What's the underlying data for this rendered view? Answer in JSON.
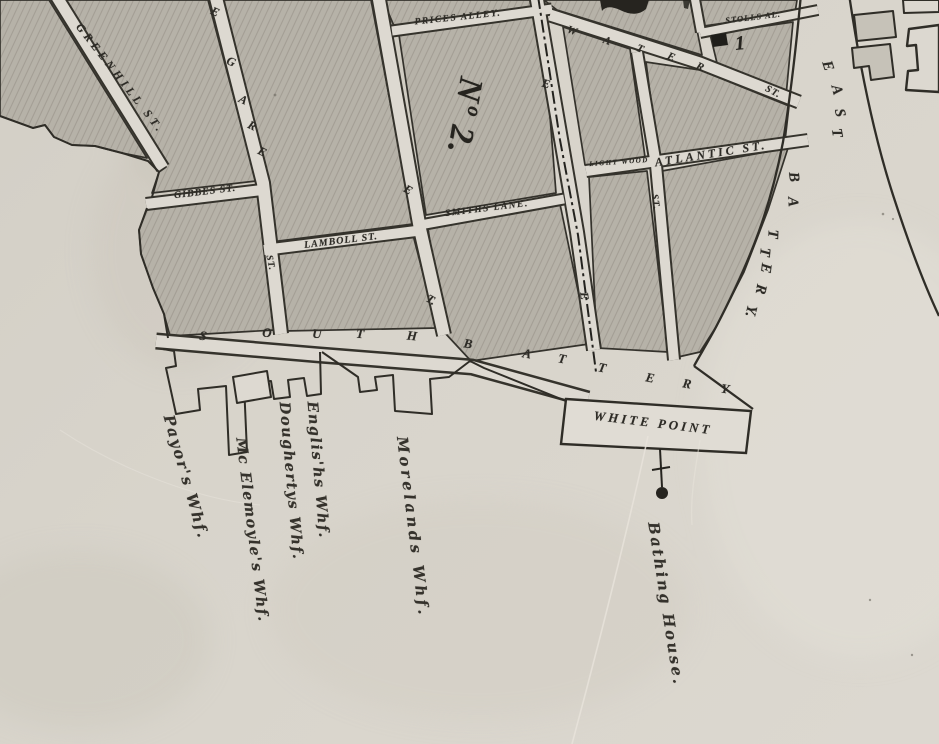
{
  "map": {
    "type": "historical-city-map-scan",
    "ward_numbers": {
      "large_numeral": "Nº 2.",
      "small_numeral": "1"
    },
    "palette": {
      "paper": "#dcd8d0",
      "block_fill": "#b6b2a8",
      "hatch_line": "#948e82",
      "ink": "#2d2b26",
      "building_fill": "#c6c2b8"
    },
    "labels": [
      {
        "name": "street-label-greenhill-st",
        "text": "GREENHILL ST.",
        "x": 120,
        "y": 79,
        "rot": 52,
        "cls": "stencil",
        "fs": 11.5,
        "ls": 4
      },
      {
        "name": "street-letter-legare-e1",
        "text": "E",
        "x": 215,
        "y": 12,
        "rot": 24,
        "cls": "stencil",
        "fs": 12,
        "ls": 0
      },
      {
        "name": "street-letter-legare-g",
        "text": "G",
        "x": 231,
        "y": 62,
        "rot": 24,
        "cls": "stencil",
        "fs": 12,
        "ls": 0
      },
      {
        "name": "street-letter-legare-a",
        "text": "A",
        "x": 243,
        "y": 100,
        "rot": 25,
        "cls": "stencil",
        "fs": 12,
        "ls": 0
      },
      {
        "name": "street-letter-legare-r",
        "text": "R",
        "x": 252,
        "y": 126,
        "rot": 26,
        "cls": "stencil",
        "fs": 12,
        "ls": 0
      },
      {
        "name": "street-letter-legare-e2",
        "text": "E",
        "x": 262,
        "y": 152,
        "rot": 27,
        "cls": "stencil",
        "fs": 12,
        "ls": 0
      },
      {
        "name": "street-label-legare-st",
        "text": "ST.",
        "x": 270,
        "y": 263,
        "rot": 78,
        "cls": "stencil",
        "fs": 9.5,
        "ls": 1
      },
      {
        "name": "street-label-gibbes-st",
        "text": "GIBBES ST.",
        "x": 205,
        "y": 192,
        "rot": -7,
        "cls": "stencil",
        "fs": 10,
        "ls": 1
      },
      {
        "name": "street-label-lamboll-st",
        "text": "LAMBOLL ST.",
        "x": 341,
        "y": 241,
        "rot": -7,
        "cls": "stencil",
        "fs": 10,
        "ls": 1
      },
      {
        "name": "street-label-prices-alley",
        "text": "PRICES ALLEY.",
        "x": 458,
        "y": 18,
        "rot": -6,
        "cls": "stencil",
        "fs": 9.5,
        "ls": 1.5
      },
      {
        "name": "ward-number-2",
        "text": "Nº 2.",
        "x": 464,
        "y": 116,
        "rot": 100,
        "cls": "ward",
        "fs": 34,
        "ls": 2
      },
      {
        "name": "street-label-smiths-lane",
        "text": "SMITHS LANE.",
        "x": 487,
        "y": 209,
        "rot": -7,
        "cls": "stencil",
        "fs": 9.5,
        "ls": 1.5
      },
      {
        "name": "street-letter-meeting-e",
        "text": "E",
        "x": 408,
        "y": 190,
        "rot": 30,
        "cls": "stencil",
        "fs": 12,
        "ls": 0
      },
      {
        "name": "street-letter-meeting-t",
        "text": "T.",
        "x": 431,
        "y": 300,
        "rot": 30,
        "cls": "stencil",
        "fs": 12,
        "ls": 0
      },
      {
        "name": "street-letter-church-e-upper",
        "text": "E",
        "x": 546,
        "y": 84,
        "rot": 15,
        "cls": "stencil",
        "fs": 12,
        "ls": 0
      },
      {
        "name": "street-letter-church-e-lower",
        "text": "E",
        "x": 584,
        "y": 296,
        "rot": 82,
        "cls": "stencil",
        "fs": 12,
        "ls": 0
      },
      {
        "name": "street-letter-water-w",
        "text": "W",
        "x": 572,
        "y": 31,
        "rot": 20,
        "cls": "stencil",
        "fs": 11,
        "ls": 0
      },
      {
        "name": "street-letter-water-a",
        "text": "A",
        "x": 607,
        "y": 41,
        "rot": 21,
        "cls": "stencil",
        "fs": 11,
        "ls": 0
      },
      {
        "name": "street-letter-water-t",
        "text": "T",
        "x": 640,
        "y": 49,
        "rot": 22,
        "cls": "stencil",
        "fs": 11,
        "ls": 0
      },
      {
        "name": "street-letter-water-e",
        "text": "E",
        "x": 671,
        "y": 57,
        "rot": 23,
        "cls": "stencil",
        "fs": 11,
        "ls": 0
      },
      {
        "name": "street-letter-water-r",
        "text": "R",
        "x": 700,
        "y": 67,
        "rot": 24,
        "cls": "stencil",
        "fs": 11,
        "ls": 0
      },
      {
        "name": "street-label-water-st",
        "text": "ST.",
        "x": 773,
        "y": 92,
        "rot": 28,
        "cls": "stencil",
        "fs": 10,
        "ls": 1
      },
      {
        "name": "street-label-stolls-alley",
        "text": "STOLLS AL.",
        "x": 753,
        "y": 17,
        "rot": -7,
        "cls": "stencil",
        "fs": 8.5,
        "ls": 1
      },
      {
        "name": "ward-number-1",
        "text": "1",
        "x": 740,
        "y": 44,
        "rot": -5,
        "cls": "ward",
        "fs": 20,
        "ls": 0
      },
      {
        "name": "street-label-lightwood",
        "text": "LIGHT WOOD",
        "x": 619,
        "y": 162,
        "rot": -4,
        "cls": "stencil",
        "fs": 7,
        "ls": 1.5
      },
      {
        "name": "street-label-atlantic-st",
        "text": "ATLANTIC ST.",
        "x": 711,
        "y": 154,
        "rot": -9,
        "cls": "stencil",
        "fs": 12,
        "ls": 3
      },
      {
        "name": "street-label-church-st",
        "text": "ST.",
        "x": 655,
        "y": 202,
        "rot": 82,
        "cls": "stencil",
        "fs": 9.5,
        "ls": 1
      },
      {
        "name": "street-letter-eastbattery-e1",
        "text": "E",
        "x": 827,
        "y": 66,
        "rot": 72,
        "cls": "stencil",
        "fs": 15,
        "ls": 0
      },
      {
        "name": "street-letter-eastbattery-a1",
        "text": "A",
        "x": 836,
        "y": 90,
        "rot": 75,
        "cls": "stencil",
        "fs": 15,
        "ls": 0
      },
      {
        "name": "street-letter-eastbattery-s",
        "text": "S",
        "x": 839,
        "y": 113,
        "rot": 78,
        "cls": "stencil",
        "fs": 15,
        "ls": 0
      },
      {
        "name": "street-letter-eastbattery-t1",
        "text": "T",
        "x": 836,
        "y": 133,
        "rot": 80,
        "cls": "stencil",
        "fs": 15,
        "ls": 0
      },
      {
        "name": "street-letter-eastbattery-b",
        "text": "B",
        "x": 793,
        "y": 177,
        "rot": 84,
        "cls": "stencil",
        "fs": 15,
        "ls": 0
      },
      {
        "name": "street-letter-eastbattery-a2",
        "text": "A",
        "x": 792,
        "y": 202,
        "rot": 87,
        "cls": "stencil",
        "fs": 15,
        "ls": 0
      },
      {
        "name": "street-letter-eastbattery-t2",
        "text": "T",
        "x": 772,
        "y": 234,
        "rot": 92,
        "cls": "stencil",
        "fs": 15,
        "ls": 0
      },
      {
        "name": "street-letter-eastbattery-t3",
        "text": "T",
        "x": 764,
        "y": 252,
        "rot": 95,
        "cls": "stencil",
        "fs": 15,
        "ls": 0
      },
      {
        "name": "street-letter-eastbattery-e2",
        "text": "E",
        "x": 765,
        "y": 268,
        "rot": 97,
        "cls": "stencil",
        "fs": 15,
        "ls": 0
      },
      {
        "name": "street-letter-eastbattery-r",
        "text": "R",
        "x": 760,
        "y": 289,
        "rot": 100,
        "cls": "stencil",
        "fs": 15,
        "ls": 0
      },
      {
        "name": "street-letter-eastbattery-y",
        "text": "Y.",
        "x": 750,
        "y": 311,
        "rot": 104,
        "cls": "stencil",
        "fs": 15,
        "ls": 0
      },
      {
        "name": "street-letter-southbattery-s",
        "text": "S",
        "x": 203,
        "y": 336,
        "rot": 8,
        "cls": "stencil",
        "fs": 13,
        "ls": 0
      },
      {
        "name": "street-letter-southbattery-o",
        "text": "O",
        "x": 267,
        "y": 333,
        "rot": 4,
        "cls": "stencil",
        "fs": 13,
        "ls": 0
      },
      {
        "name": "street-letter-southbattery-u",
        "text": "U",
        "x": 317,
        "y": 334,
        "rot": 4,
        "cls": "stencil",
        "fs": 13,
        "ls": 0
      },
      {
        "name": "street-letter-southbattery-t1",
        "text": "T",
        "x": 360,
        "y": 334,
        "rot": 5,
        "cls": "stencil",
        "fs": 13,
        "ls": 0
      },
      {
        "name": "street-letter-southbattery-h",
        "text": "H",
        "x": 412,
        "y": 336,
        "rot": 6,
        "cls": "stencil",
        "fs": 13,
        "ls": 0
      },
      {
        "name": "street-letter-southbattery-b",
        "text": "B",
        "x": 468,
        "y": 344,
        "rot": 9,
        "cls": "stencil",
        "fs": 13,
        "ls": 0
      },
      {
        "name": "street-letter-southbattery-a",
        "text": "A",
        "x": 527,
        "y": 354,
        "rot": 10,
        "cls": "stencil",
        "fs": 13,
        "ls": 0
      },
      {
        "name": "street-letter-southbattery-t2",
        "text": "T",
        "x": 562,
        "y": 359,
        "rot": 10,
        "cls": "stencil",
        "fs": 13,
        "ls": 0
      },
      {
        "name": "street-letter-southbattery-t3",
        "text": "T",
        "x": 602,
        "y": 368,
        "rot": 11,
        "cls": "stencil",
        "fs": 13,
        "ls": 0
      },
      {
        "name": "street-letter-southbattery-e",
        "text": "E",
        "x": 650,
        "y": 378,
        "rot": 11,
        "cls": "stencil",
        "fs": 13,
        "ls": 0
      },
      {
        "name": "street-letter-southbattery-r",
        "text": "R",
        "x": 687,
        "y": 384,
        "rot": 10,
        "cls": "stencil",
        "fs": 13,
        "ls": 0
      },
      {
        "name": "street-letter-southbattery-y",
        "text": "Y",
        "x": 725,
        "y": 389,
        "rot": 10,
        "cls": "stencil",
        "fs": 13,
        "ls": 0
      },
      {
        "name": "place-label-white-point",
        "text": "WHITE POINT",
        "x": 653,
        "y": 423,
        "rot": 7,
        "cls": "stencil",
        "fs": 13,
        "ls": 3
      },
      {
        "name": "place-label-bathing-house",
        "text": "Bathing House.",
        "x": 666,
        "y": 604,
        "rot": 81,
        "cls": "script",
        "fs": 15,
        "ls": 2.5
      },
      {
        "name": "wharf-label-payors",
        "text": "Payor's Whf.",
        "x": 186,
        "y": 477,
        "rot": 74,
        "cls": "script",
        "fs": 15,
        "ls": 2
      },
      {
        "name": "wharf-label-mc-elemoyles",
        "text": "Mc Elemoyle's Whf.",
        "x": 252,
        "y": 530,
        "rot": 83,
        "cls": "script",
        "fs": 14.5,
        "ls": 1.5
      },
      {
        "name": "wharf-label-doughertys",
        "text": "Doughertys Whf.",
        "x": 291,
        "y": 481,
        "rot": 85,
        "cls": "script",
        "fs": 14.5,
        "ls": 1.5
      },
      {
        "name": "wharf-label-englishs",
        "text": "Englis'hs Whf.",
        "x": 318,
        "y": 470,
        "rot": 85,
        "cls": "script",
        "fs": 14.5,
        "ls": 1.5
      },
      {
        "name": "wharf-label-morelands",
        "text": "Morelands Whf.",
        "x": 413,
        "y": 527,
        "rot": 83,
        "cls": "script",
        "fs": 15,
        "ls": 3.5
      }
    ]
  }
}
